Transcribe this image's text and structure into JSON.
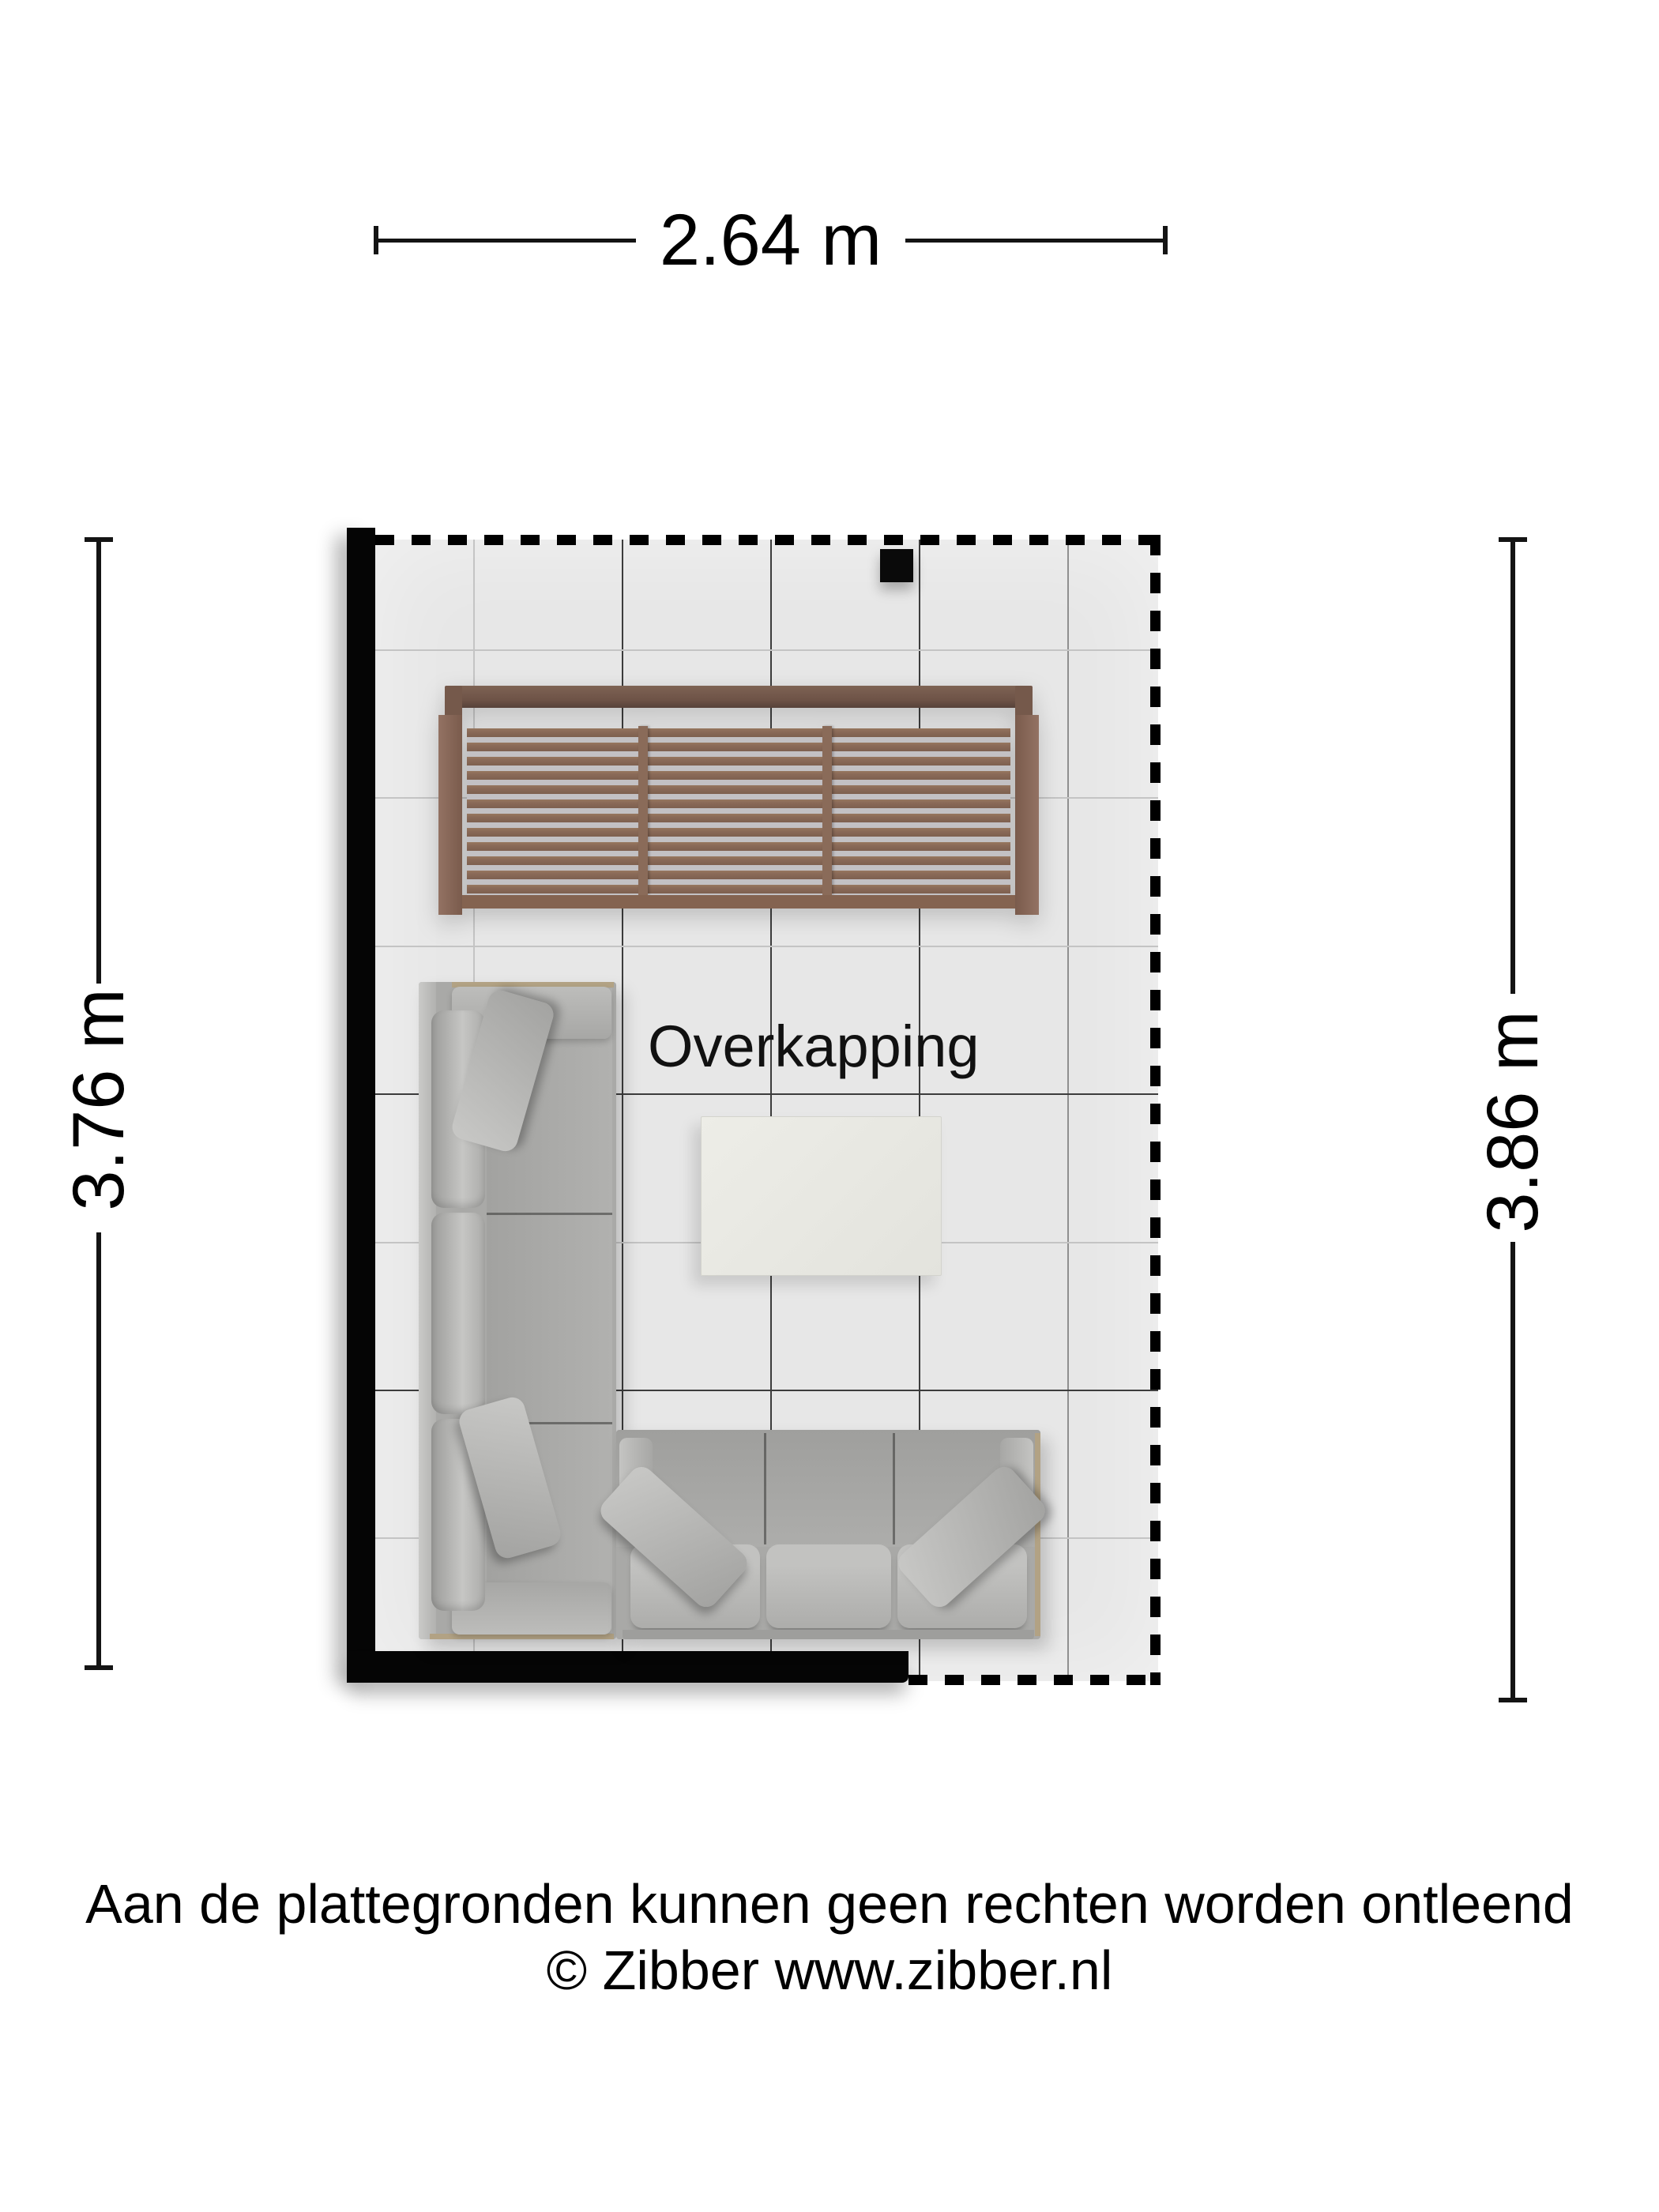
{
  "plan": {
    "room_label": "Overkapping",
    "dimensions": {
      "width_top": "2.64 m",
      "height_left": "3.76 m",
      "height_right": "3.86 m"
    },
    "furniture": [
      {
        "name": "louvered-pergola-screen"
      },
      {
        "name": "corner-sofa-long-section"
      },
      {
        "name": "corner-sofa-short-section"
      },
      {
        "name": "coffee-table"
      },
      {
        "name": "post"
      }
    ],
    "walls": {
      "solid": [
        "left",
        "bottom-left"
      ],
      "dashed_boundary": [
        "top",
        "right",
        "bottom-right"
      ]
    }
  },
  "footer": {
    "disclaimer": "Aan de plattegronden kunnen geen rechten worden ontleend",
    "copyright": "© Zibber www.zibber.nl"
  },
  "colors": {
    "background": "#ffffff",
    "floor": "#e7e7e7",
    "wall": "#000000",
    "wood": "#8a6b59",
    "sofa_fabric": "#adadab",
    "table_top": "#e9e9e3",
    "frame_trim": "#b2a284"
  }
}
